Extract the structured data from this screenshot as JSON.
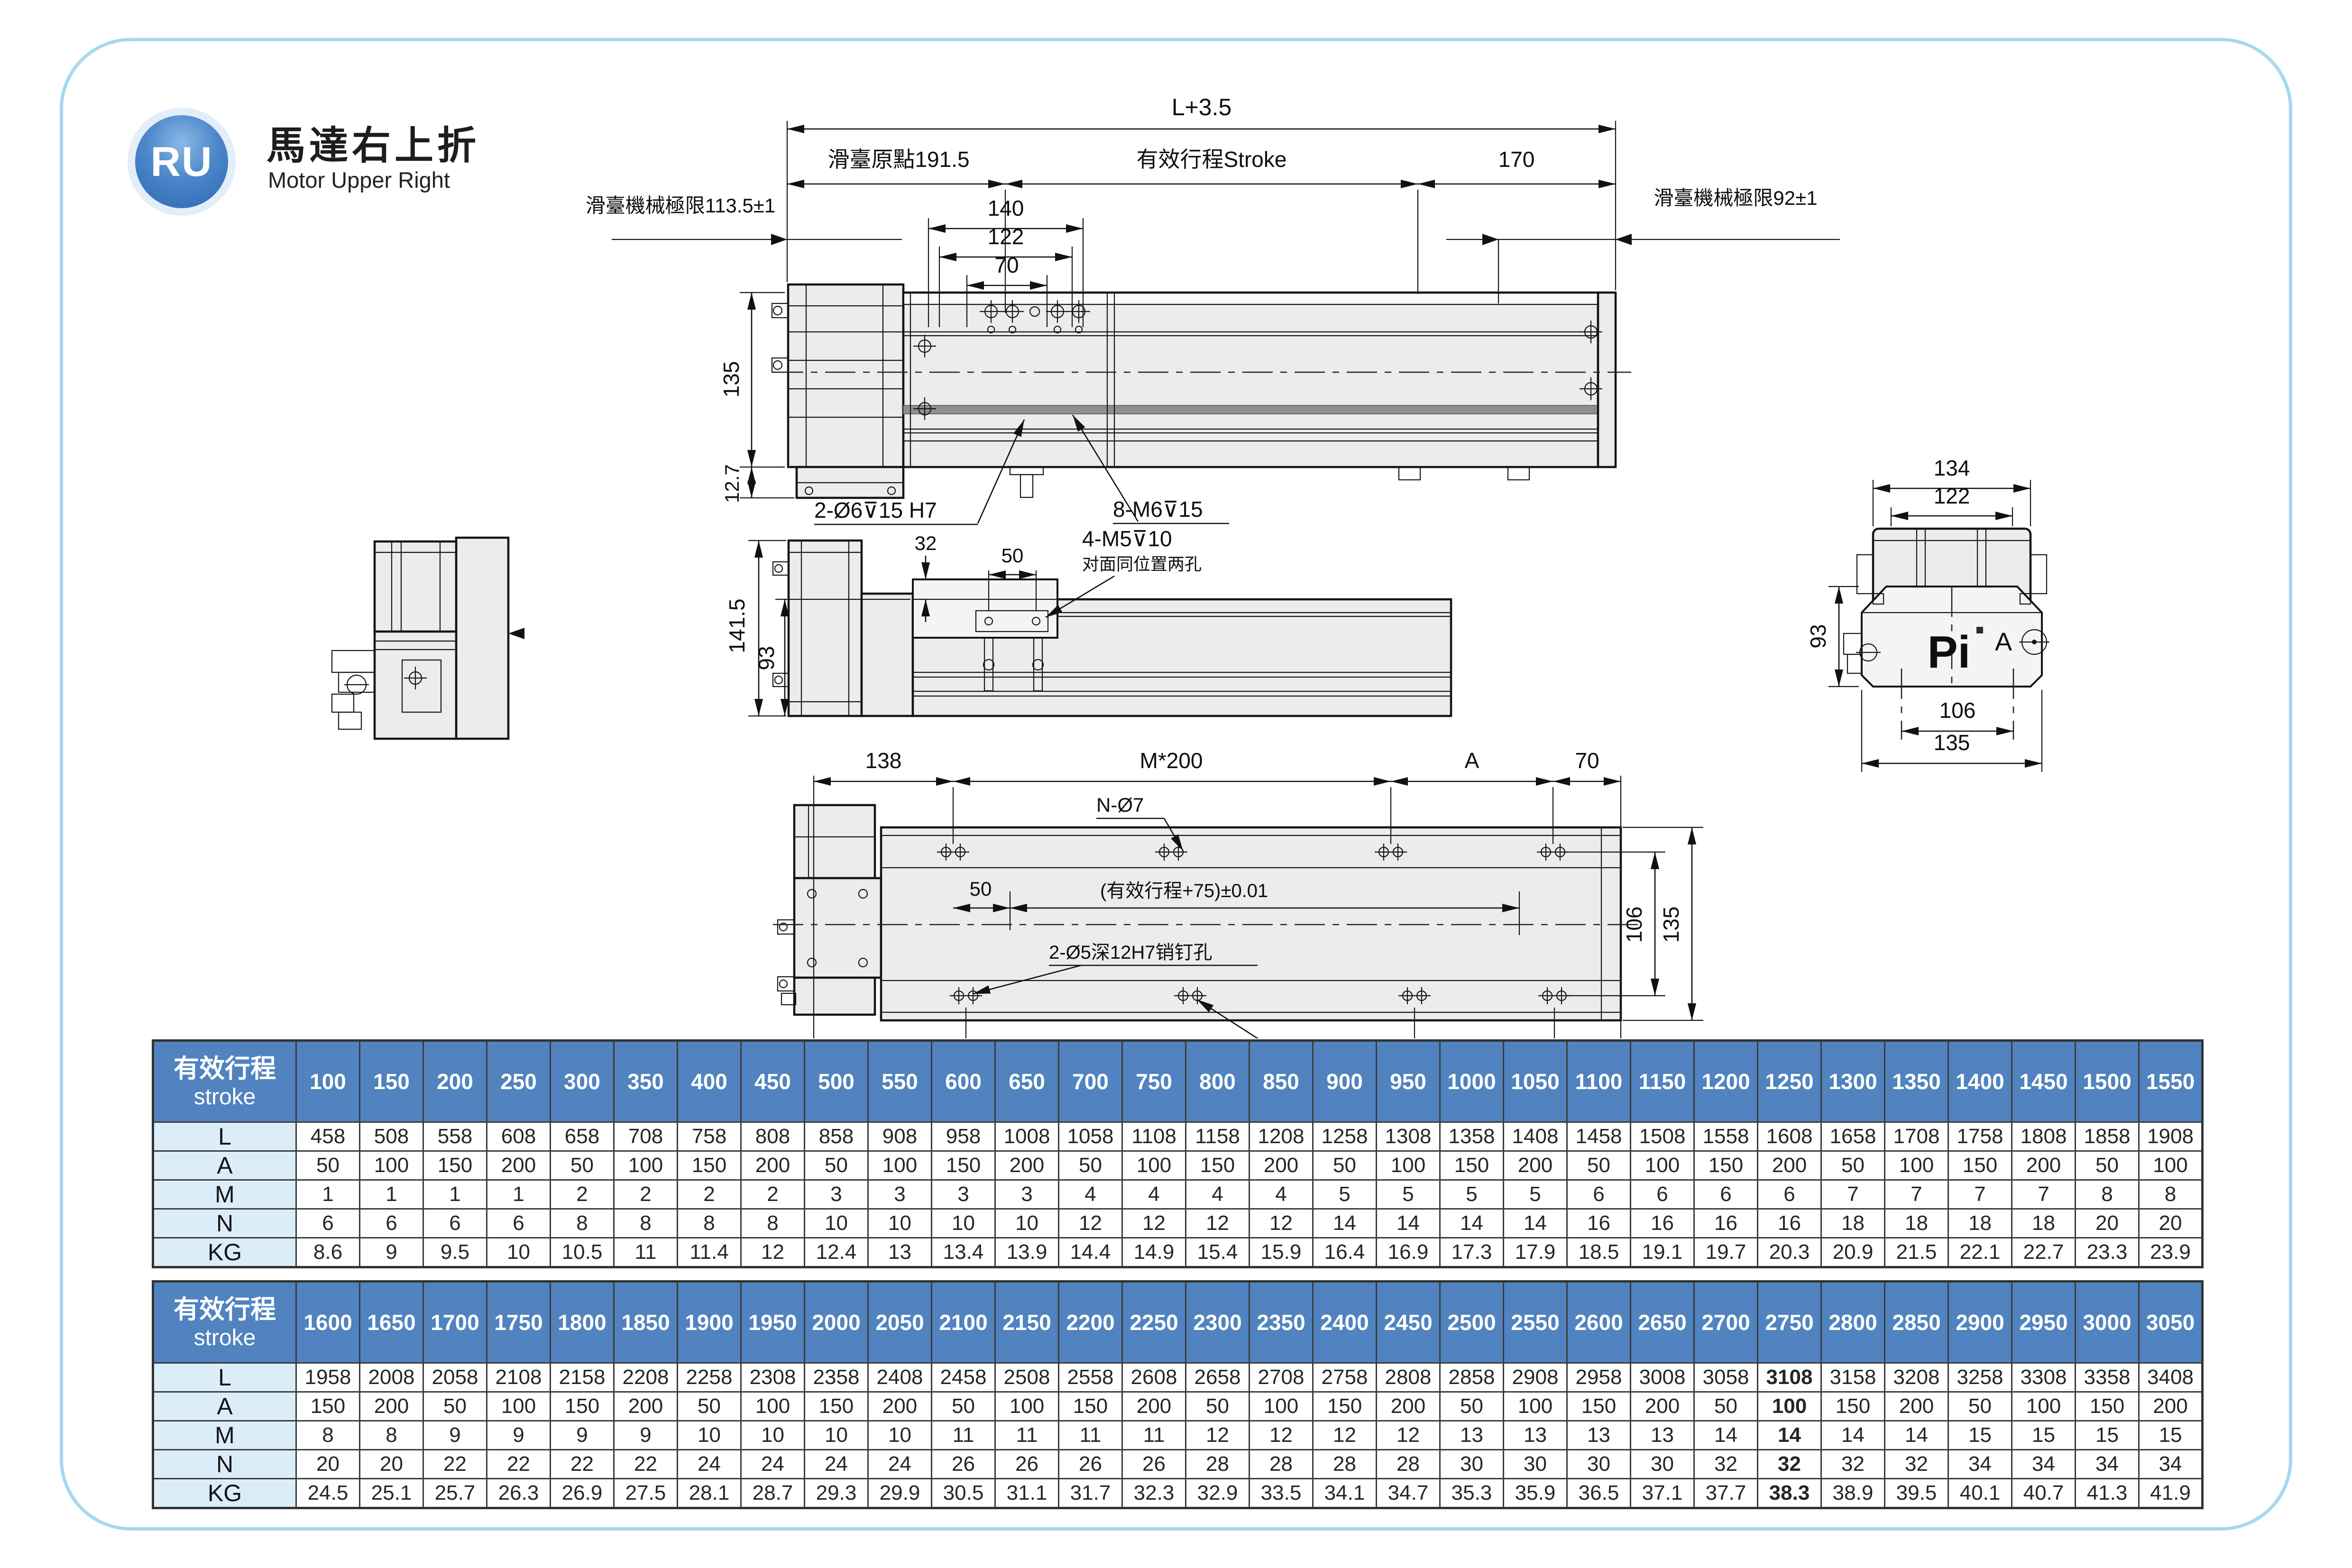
{
  "logo": {
    "initials": "RU",
    "title_zh": "馬達右上折",
    "title_en": "Motor Upper Right",
    "badge_color": "#3b76bc"
  },
  "drawings": {
    "front": {
      "dim_total": "L+3.5",
      "dim_origin": "滑臺原點191.5",
      "dim_stroke": "有效行程Stroke",
      "dim_170": "170",
      "dim_140": "140",
      "dim_122": "122",
      "dim_70": "70",
      "limit_left": "滑臺機械極限113.5±1",
      "limit_right": "滑臺機械極限92±1",
      "dim_135": "135",
      "dim_12_7": "12.7",
      "callout_dowel": "2-Ø6⊽15 H7",
      "callout_screws": "8-M6⊽15"
    },
    "side": {
      "dim_141_5": "141.5",
      "dim_93": "93",
      "dim_32": "32",
      "dim_50": "50",
      "callout_screws": "4-M5⊽10",
      "callout_note": "对面同位置两孔"
    },
    "end": {
      "dim_134": "134",
      "dim_122": "122",
      "dim_93": "93",
      "dim_106": "106",
      "dim_135": "135",
      "brand": "Pi",
      "section_label": "A"
    },
    "top": {
      "dim_138": "138",
      "dim_m200_top": "M*200",
      "dim_a_top": "A",
      "dim_70": "70",
      "callout_holes": "N-Ø7",
      "dim_50": "50",
      "dim_stroke_tol": "(有效行程+75)±0.01",
      "callout_pin": "2-Ø5深12H7销钉孔",
      "callout_screws": "N-M6⊽10",
      "dim_148": "148",
      "dim_m200_bottom": "M*200",
      "dim_a_bottom": "A",
      "dim_60": "60",
      "dim_106": "106",
      "dim_135": "135"
    }
  },
  "tables": {
    "header_zh": "有效行程",
    "header_en": "stroke",
    "row_labels": [
      "L",
      "A",
      "M",
      "N",
      "KG"
    ],
    "list": [
      {
        "strokes": [
          100,
          150,
          200,
          250,
          300,
          350,
          400,
          450,
          500,
          550,
          600,
          650,
          700,
          750,
          800,
          850,
          900,
          950,
          1000,
          1050,
          1100,
          1150,
          1200,
          1250,
          1300,
          1350,
          1400,
          1450,
          1500,
          1550
        ],
        "rows": {
          "L": [
            458,
            508,
            558,
            608,
            658,
            708,
            758,
            808,
            858,
            908,
            958,
            1008,
            1058,
            1108,
            1158,
            1208,
            1258,
            1308,
            1358,
            1408,
            1458,
            1508,
            1558,
            1608,
            1658,
            1708,
            1758,
            1808,
            1858,
            1908
          ],
          "A": [
            50,
            100,
            150,
            200,
            50,
            100,
            150,
            200,
            50,
            100,
            150,
            200,
            50,
            100,
            150,
            200,
            50,
            100,
            150,
            200,
            50,
            100,
            150,
            200,
            50,
            100,
            150,
            200,
            50,
            100
          ],
          "M": [
            1,
            1,
            1,
            1,
            2,
            2,
            2,
            2,
            3,
            3,
            3,
            3,
            4,
            4,
            4,
            4,
            5,
            5,
            5,
            5,
            6,
            6,
            6,
            6,
            7,
            7,
            7,
            7,
            8,
            8
          ],
          "N": [
            6,
            6,
            6,
            6,
            8,
            8,
            8,
            8,
            10,
            10,
            10,
            10,
            12,
            12,
            12,
            12,
            14,
            14,
            14,
            14,
            16,
            16,
            16,
            16,
            18,
            18,
            18,
            18,
            20,
            20
          ],
          "KG": [
            8.6,
            9,
            9.5,
            10,
            10.5,
            11,
            11.4,
            12,
            12.4,
            13,
            13.4,
            13.9,
            14.4,
            14.9,
            15.4,
            15.9,
            16.4,
            16.9,
            17.3,
            17.9,
            18.5,
            19.1,
            19.7,
            20.3,
            20.9,
            21.5,
            22.1,
            22.7,
            23.3,
            23.9
          ]
        }
      },
      {
        "strokes": [
          1600,
          1650,
          1700,
          1750,
          1800,
          1850,
          1900,
          1950,
          2000,
          2050,
          2100,
          2150,
          2200,
          2250,
          2300,
          2350,
          2400,
          2450,
          2500,
          2550,
          2600,
          2650,
          2700,
          2750,
          2800,
          2850,
          2900,
          2950,
          3000,
          3050
        ],
        "bold_stroke": "2750",
        "rows": {
          "L": [
            1958,
            2008,
            2058,
            2108,
            2158,
            2208,
            2258,
            2308,
            2358,
            2408,
            2458,
            2508,
            2558,
            2608,
            2658,
            2708,
            2758,
            2808,
            2858,
            2908,
            2958,
            3008,
            3058,
            3108,
            3158,
            3208,
            3258,
            3308,
            3358,
            3408
          ],
          "A": [
            150,
            200,
            50,
            100,
            150,
            200,
            50,
            100,
            150,
            200,
            50,
            100,
            150,
            200,
            50,
            100,
            150,
            200,
            50,
            100,
            150,
            200,
            50,
            100,
            150,
            200,
            50,
            100,
            150,
            200
          ],
          "M": [
            8,
            8,
            9,
            9,
            9,
            9,
            10,
            10,
            10,
            10,
            11,
            11,
            11,
            11,
            12,
            12,
            12,
            12,
            13,
            13,
            13,
            13,
            14,
            14,
            14,
            14,
            15,
            15,
            15,
            15
          ],
          "N": [
            20,
            20,
            22,
            22,
            22,
            22,
            24,
            24,
            24,
            24,
            26,
            26,
            26,
            26,
            28,
            28,
            28,
            28,
            30,
            30,
            30,
            30,
            32,
            32,
            32,
            32,
            34,
            34,
            34,
            34
          ],
          "KG": [
            24.5,
            25.1,
            25.7,
            26.3,
            26.9,
            27.5,
            28.1,
            28.7,
            29.3,
            29.9,
            30.5,
            31.1,
            31.7,
            32.3,
            32.9,
            33.5,
            34.1,
            34.7,
            35.3,
            35.9,
            36.5,
            37.1,
            37.7,
            38.3,
            38.9,
            39.5,
            40.1,
            40.7,
            41.3,
            41.9
          ]
        }
      }
    ]
  }
}
